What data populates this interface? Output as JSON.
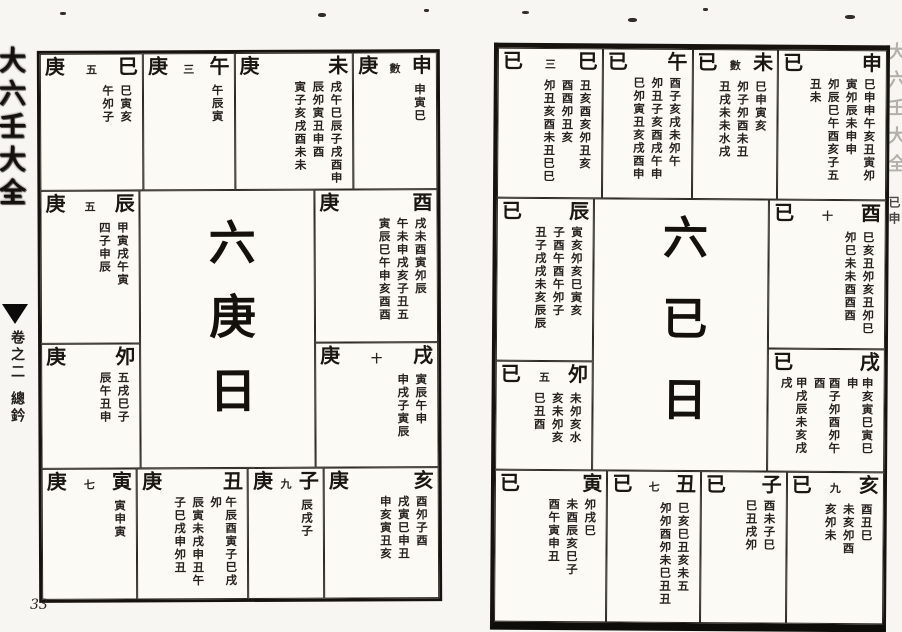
{
  "colors": {
    "paper": "#fbfaf5",
    "ink": "#16130f"
  },
  "spine": {
    "title": "大六壬大全",
    "volume": "卷之二",
    "section": "總鈐"
  },
  "page_number": "33",
  "edge_strip": {
    "faint_text": "大六壬大全",
    "dark_text": "已申"
  },
  "left_page": {
    "center": "六庚日",
    "top": [
      {
        "stem": "庚",
        "note": "五",
        "branch": "巳",
        "cols": [
          "巳寅亥",
          "午夘子"
        ]
      },
      {
        "stem": "庚",
        "note": "三",
        "branch": "午",
        "cols": [
          "午辰寅"
        ]
      },
      {
        "stem": "庚",
        "note": "",
        "branch": "未",
        "cols": [
          "戌午巳辰子戌酉申",
          "辰夘寅丑申酉",
          "寅子亥戌酉未未"
        ]
      },
      {
        "stem": "庚",
        "note": "數",
        "branch": "申",
        "cols": [
          "申寅巳"
        ]
      }
    ],
    "left": [
      {
        "stem": "庚",
        "note": "五",
        "branch": "辰",
        "cols": [
          "甲寅戌午寅",
          "四子申辰"
        ]
      },
      {
        "stem": "庚",
        "note": "",
        "branch": "夘",
        "cols": [
          "五戌巳子",
          "辰午丑申"
        ]
      }
    ],
    "right": [
      {
        "stem": "庚",
        "note": "",
        "branch": "酉",
        "cols": [
          "戌未酉寅夘辰",
          "午未申戌亥子丑五",
          "寅辰巳午申亥酉酉"
        ]
      },
      {
        "stem": "庚",
        "note": "十",
        "branch": "戌",
        "cols": [
          "寅辰午申",
          "申戌子寅辰"
        ]
      }
    ],
    "bottom": [
      {
        "stem": "庚",
        "note": "七",
        "branch": "寅",
        "cols": [
          "寅申寅"
        ]
      },
      {
        "stem": "庚",
        "note": "",
        "branch": "丑",
        "cols": [
          "午辰酉寅子巳戌夘",
          "辰寅未戌申丑午",
          "子巳戌申夘丑"
        ]
      },
      {
        "stem": "庚",
        "note": "九",
        "branch": "子",
        "cols": [
          "辰戌子"
        ]
      },
      {
        "stem": "庚",
        "note": "",
        "branch": "亥",
        "cols": [
          "酉夘子酉",
          "戌寅巳申丑",
          "申亥寅丑亥"
        ]
      }
    ]
  },
  "right_page": {
    "center": "六已日",
    "top": [
      {
        "stem": "已",
        "note": "三",
        "branch": "巳",
        "cols": [
          "丑亥酉亥夘丑亥",
          "酉酉夘丑亥",
          "夘丑亥酉未丑巳巳"
        ]
      },
      {
        "stem": "已",
        "note": "",
        "branch": "午",
        "cols": [
          "酉子亥戌未夘午",
          "夘丑子亥酉戌午申",
          "巳夘寅丑亥戌酉申"
        ]
      },
      {
        "stem": "已",
        "note": "數",
        "branch": "未",
        "cols": [
          "巳申寅亥",
          "夘子夘酉未丑",
          "丑戌未未水戌"
        ]
      },
      {
        "stem": "已",
        "note": "",
        "branch": "申",
        "cols": [
          "巳申申午亥丑寅夘",
          "寅夘辰未申申",
          "夘辰巳午酉亥子五",
          "丑未"
        ]
      }
    ],
    "left": [
      {
        "stem": "已",
        "note": "",
        "branch": "辰",
        "cols": [
          "寅亥夘亥巳寅亥",
          "子酉午酉午夘子",
          "丑子戌戌未亥辰辰"
        ]
      },
      {
        "stem": "已",
        "note": "五",
        "branch": "夘",
        "cols": [
          "未夘亥水",
          "亥未夘亥",
          "巳丑酉"
        ]
      }
    ],
    "right": [
      {
        "stem": "已",
        "note": "十",
        "branch": "酉",
        "cols": [
          "巳亥丑夘亥丑夘巳",
          "夘巳未未酉酉酉"
        ]
      },
      {
        "stem": "已",
        "note": "",
        "branch": "戌",
        "cols": [
          "申亥寅巳寅巳申",
          "酉子夘酉夘午酉",
          "甲戌辰未亥戌戌"
        ]
      }
    ],
    "bottom": [
      {
        "stem": "已",
        "note": "",
        "branch": "寅",
        "cols": [
          "夘戌巳",
          "未酉辰亥巳子",
          "酉午寅申丑"
        ]
      },
      {
        "stem": "已",
        "note": "七",
        "branch": "丑",
        "cols": [
          "巳亥巳丑亥未五",
          "夘夘酉夘未巳丑丑"
        ]
      },
      {
        "stem": "已",
        "note": "",
        "branch": "子",
        "cols": [
          "酉未子巳",
          "巳丑戌夘"
        ]
      },
      {
        "stem": "已",
        "note": "九",
        "branch": "亥",
        "cols": [
          "酉丑巳",
          "未亥夘酉",
          "亥夘未"
        ]
      }
    ]
  }
}
